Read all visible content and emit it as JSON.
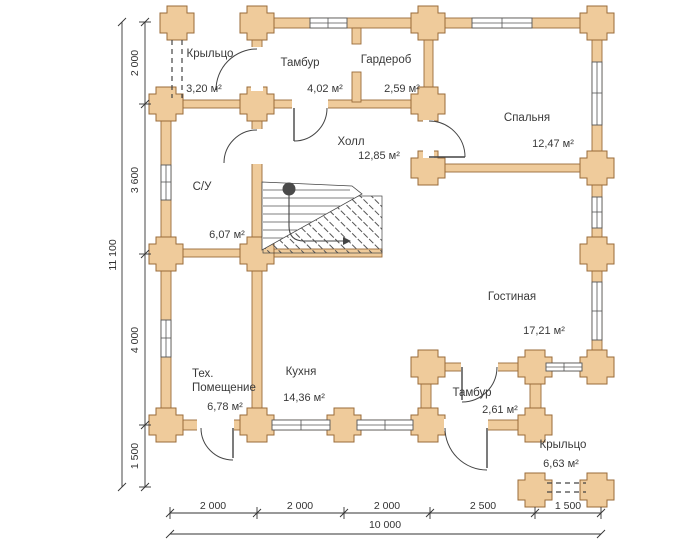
{
  "title": "План 1 этажа",
  "rooms": {
    "porch_top": {
      "name": "Крыльцо",
      "area": "3,20 м²"
    },
    "tambour_top": {
      "name": "Тамбур",
      "area": "4,02 м²"
    },
    "wardrobe": {
      "name": "Гардероб",
      "area": "2,59 м²"
    },
    "bedroom": {
      "name": "Спальня",
      "area": "12,47 м²"
    },
    "hall": {
      "name": "Холл",
      "area": "12,85 м²"
    },
    "bathroom": {
      "name": "С/У",
      "area": "6,07 м²"
    },
    "living_room": {
      "name": "Гостиная",
      "area": "17,21 м²"
    },
    "tech_room": {
      "name_line1": "Тех.",
      "name_line2": "Помещение",
      "area": "6,78 м²"
    },
    "kitchen": {
      "name": "Кухня",
      "area": "14,36 м²"
    },
    "tambour_bottom": {
      "name": "Тамбур",
      "area": "2,61 м²"
    },
    "porch_bottom": {
      "name": "Крыльцо",
      "area": "6,63 м²"
    }
  },
  "dimensions": {
    "left": {
      "segments": [
        "2 000",
        "3 600",
        "4 000",
        "1 500"
      ],
      "total": "11 100"
    },
    "bottom": {
      "segments": [
        "2 000",
        "2 000",
        "2 000",
        "2 500",
        "1 500"
      ],
      "total": "10 000"
    }
  },
  "colors": {
    "wall_fill": "#efcb9b",
    "wall_stroke": "#9a6b3a",
    "line": "#444444",
    "text": "#3a3a3a"
  }
}
